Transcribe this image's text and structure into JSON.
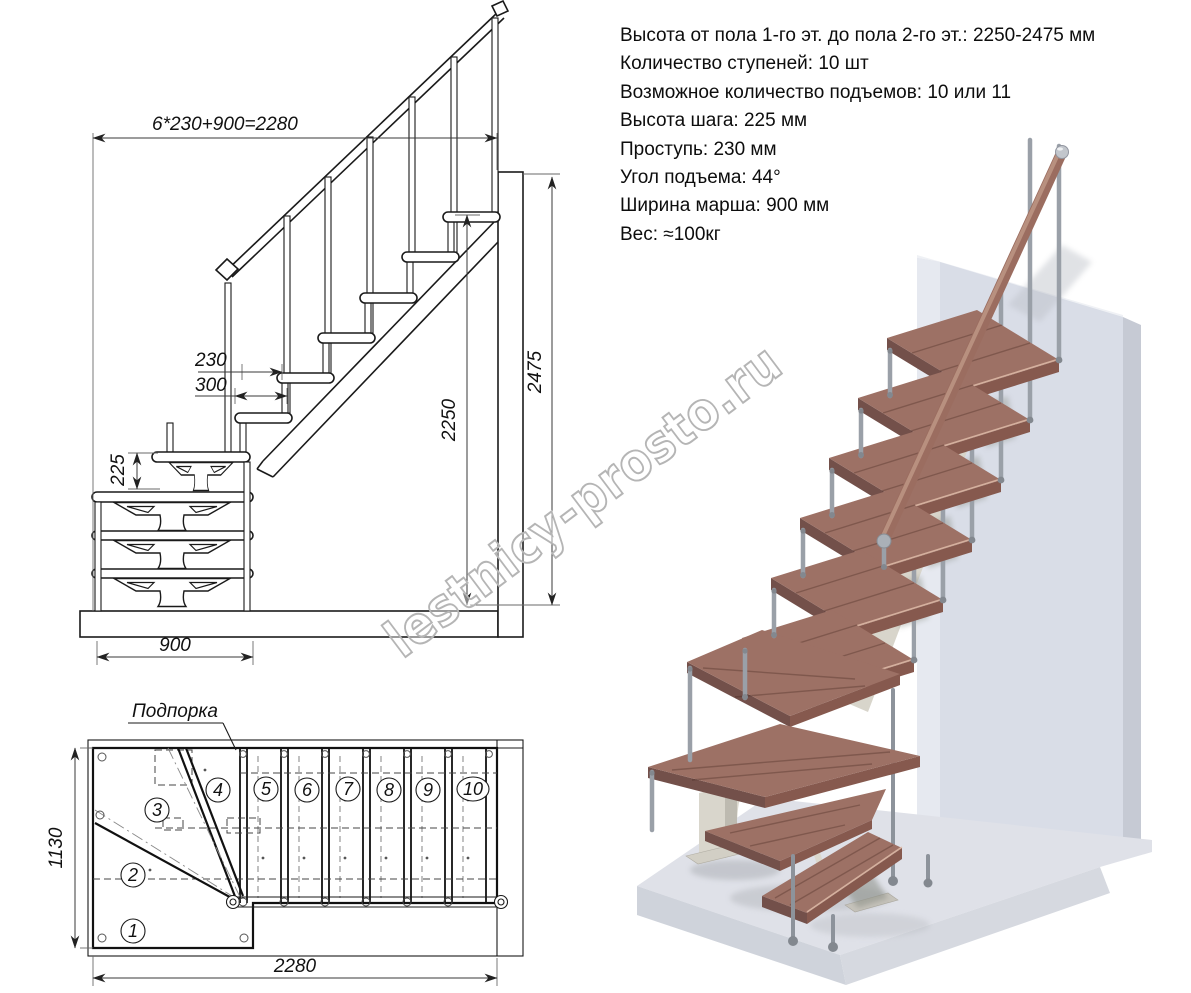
{
  "specs": {
    "lines": [
      "Высота от пола 1-го эт. до пола 2-го эт.: 2250-2475 мм",
      "Количество ступеней: 10 шт",
      "Возможное количество подъемов: 10 или 11",
      "Высота шага: 225 мм",
      "Проступь: 230 мм",
      "Угол подъема: 44°",
      "Ширина марша: 900 мм",
      "Вес: ≈100кг"
    ]
  },
  "elevation": {
    "run_formula": "6*230+900=2280",
    "dim_230": "230",
    "dim_300": "300",
    "dim_225": "225",
    "dim_2250": "2250",
    "dim_2475": "2475",
    "dim_900": "900"
  },
  "plan": {
    "support_label": "Подпорка",
    "dim_1130": "1130",
    "dim_2280": "2280",
    "steps": [
      "1",
      "2",
      "3",
      "4",
      "5",
      "6",
      "7",
      "8",
      "9",
      "10"
    ]
  },
  "watermark": {
    "text": "lestnicy-prosto.ru"
  },
  "colors": {
    "wood_top": "#9d7165",
    "wood_front": "#86594e",
    "wall": "#d9dde7",
    "floor": "#dfe1e8",
    "metal": "#9aa0a8",
    "stringer_cream": "#d8d5cb",
    "drawing_line": "#1a1a1a"
  }
}
